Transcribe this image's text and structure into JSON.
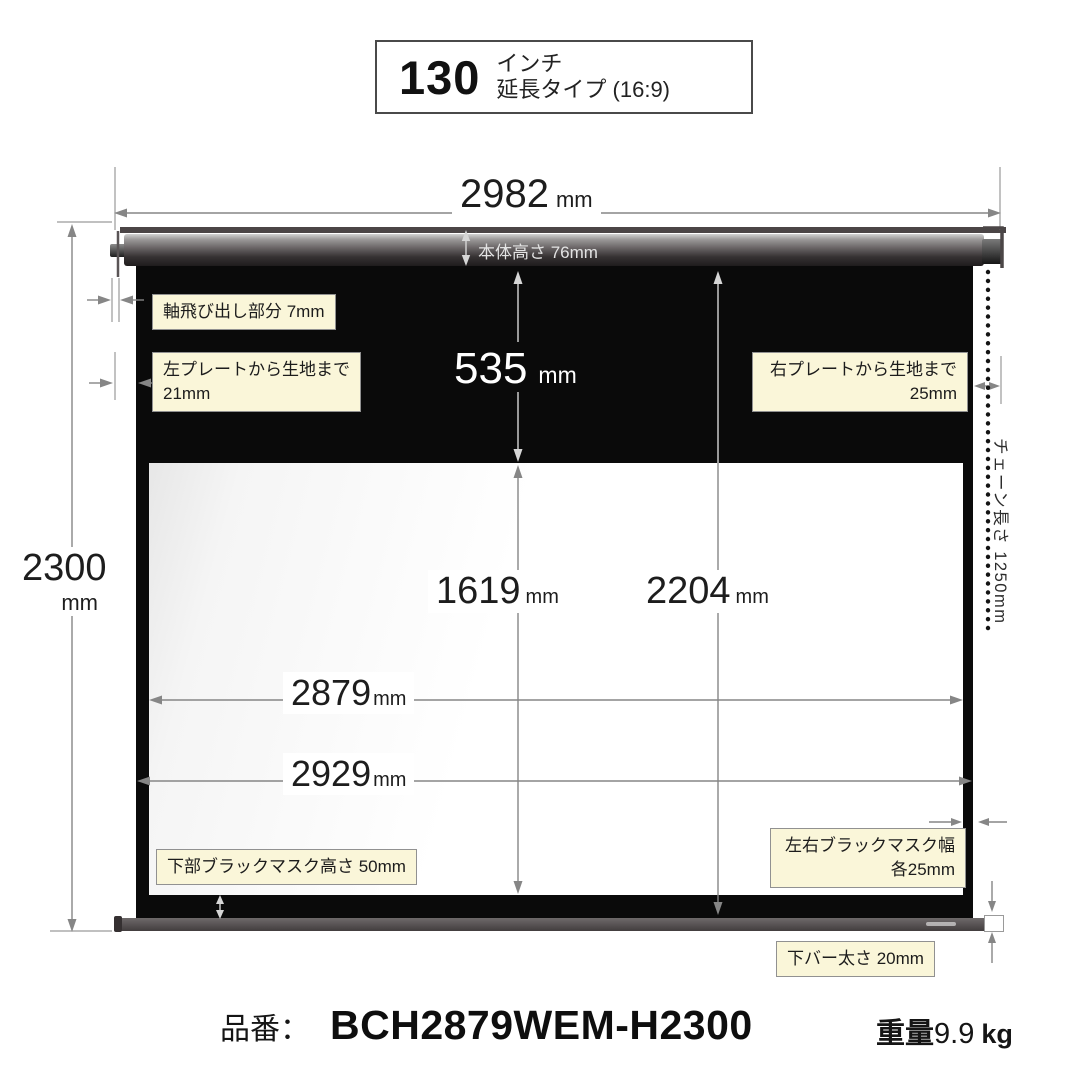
{
  "header": {
    "size": "130",
    "unit": "インチ",
    "type": "延長タイプ (16:9)"
  },
  "dims": {
    "total_width": {
      "value": "2982",
      "unit": "mm"
    },
    "total_height": {
      "value": "2300",
      "unit": "mm"
    },
    "body_height_label": "本体高さ 76mm",
    "top_black": {
      "value": "535",
      "unit": "mm"
    },
    "view_height": {
      "value": "1619",
      "unit": "mm"
    },
    "fabric_height": {
      "value": "2204",
      "unit": "mm"
    },
    "view_width": {
      "value": "2879",
      "unit": "mm"
    },
    "fabric_width": {
      "value": "2929",
      "unit": "mm"
    }
  },
  "callouts": {
    "axle": "軸飛び出し部分 7mm",
    "left_plate": {
      "line1": "左プレートから生地まで",
      "line2": "21mm"
    },
    "right_plate": {
      "line1": "右プレートから生地まで",
      "line2": "25mm"
    },
    "side_mask": {
      "line1": "左右ブラックマスク幅",
      "line2": "各25mm"
    },
    "bottom_mask": "下部ブラックマスク高さ 50mm",
    "bottom_bar": "下バー太さ 20mm",
    "chain": "チェーン長さ 1250mm"
  },
  "footer": {
    "part_label": "品番：",
    "part_number": "BCH2879WEM-H2300",
    "weight_label": "重量",
    "weight_value": "9.9",
    "weight_unit": "kg"
  },
  "colors": {
    "callout_bg": "#faf6d9",
    "callout_border": "#919191",
    "screen_black": "#0a0a0a",
    "dim_line": "#868686",
    "roller_dark": "#2a2728"
  }
}
